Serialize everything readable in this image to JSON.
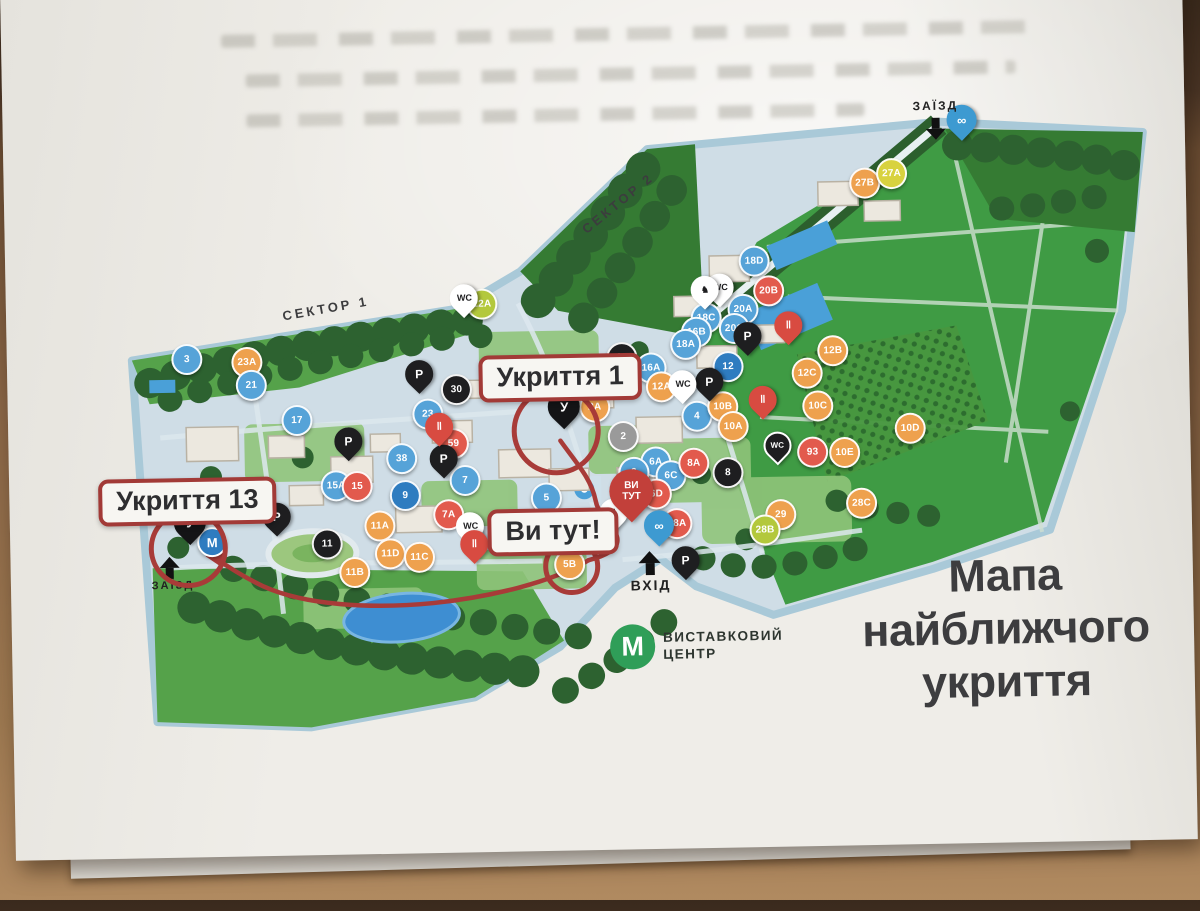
{
  "photo": {
    "title_lines": [
      "Мапа",
      "найближчого",
      "укриття"
    ]
  },
  "map": {
    "sector1": "СЕКТОР 1",
    "sector2": "СЕКТОР 2",
    "entry_top": "ЗАЇЗД",
    "entry_left": "ЗАЇЗД",
    "entrance_bottom": "ВХІД",
    "labels": {
      "shelter1": "Укриття 1",
      "shelter13": "Укриття 13",
      "you_here": "Ви тут!"
    },
    "you_pin": {
      "line1": "ВИ",
      "line2": "ТУТ",
      "x": 630,
      "y": 505
    },
    "metro_station": {
      "glyph": "М",
      "x": 210,
      "y": 535
    },
    "logo": {
      "letter": "М",
      "line1": "ВИСТАВКОВИЙ",
      "line2": "ЦЕНТР"
    },
    "colors": {
      "marker_blue": "#56a3d8",
      "marker_blue_dark": "#2e7cc0",
      "marker_orange": "#eea14e",
      "marker_red": "#e25a4d",
      "marker_black": "#1e1e20",
      "marker_gray": "#9a9a9a",
      "marker_yellow": "#d8d23f",
      "marker_lime": "#b3c83c",
      "route_red": "#a83b38",
      "logo_green": "#2f9e58",
      "title_gray": "#3d3d3f"
    },
    "markers": [
      {
        "label": "27B",
        "x": 869,
        "y": 188,
        "c": "orange"
      },
      {
        "label": "27A",
        "x": 896,
        "y": 179,
        "c": "yellow"
      },
      {
        "label": "22A",
        "x": 484,
        "y": 302,
        "c": "lime"
      },
      {
        "label": "18D",
        "x": 757,
        "y": 264,
        "c": "blue"
      },
      {
        "label": "20B",
        "x": 771,
        "y": 294,
        "c": "red"
      },
      {
        "label": "20A",
        "x": 745,
        "y": 312,
        "c": "blue"
      },
      {
        "label": "18C",
        "x": 708,
        "y": 320,
        "c": "blue"
      },
      {
        "label": "16B",
        "x": 698,
        "y": 334,
        "c": "blue"
      },
      {
        "label": "18A",
        "x": 687,
        "y": 346,
        "c": "blue"
      },
      {
        "label": "20C",
        "x": 736,
        "y": 331,
        "c": "blue"
      },
      {
        "label": "12",
        "x": 729,
        "y": 369,
        "c": "blue2"
      },
      {
        "label": "12B",
        "x": 834,
        "y": 355,
        "c": "orange"
      },
      {
        "label": "12C",
        "x": 808,
        "y": 377,
        "c": "orange"
      },
      {
        "label": "10C",
        "x": 818,
        "y": 410,
        "c": "orange"
      },
      {
        "label": "10E",
        "x": 844,
        "y": 457,
        "c": "orange"
      },
      {
        "label": "10D",
        "x": 910,
        "y": 434,
        "c": "orange"
      },
      {
        "label": "93",
        "x": 812,
        "y": 456,
        "c": "red"
      },
      {
        "label": "28C",
        "x": 860,
        "y": 508,
        "c": "orange"
      },
      {
        "label": "29",
        "x": 779,
        "y": 518,
        "c": "orange"
      },
      {
        "label": "28B",
        "x": 763,
        "y": 533,
        "c": "lime"
      },
      {
        "label": "28A",
        "x": 675,
        "y": 525,
        "c": "red"
      },
      {
        "label": "16",
        "x": 623,
        "y": 358,
        "c": "black"
      },
      {
        "label": "16A",
        "x": 652,
        "y": 369,
        "c": "blue"
      },
      {
        "label": "12A",
        "x": 662,
        "y": 388,
        "c": "orange"
      },
      {
        "label": "2A",
        "x": 595,
        "y": 407,
        "c": "orange"
      },
      {
        "label": "2",
        "x": 623,
        "y": 437,
        "c": "gray"
      },
      {
        "label": "4",
        "x": 697,
        "y": 418,
        "c": "blue"
      },
      {
        "label": "10B",
        "x": 723,
        "y": 409,
        "c": "orange"
      },
      {
        "label": "10A",
        "x": 733,
        "y": 429,
        "c": "orange"
      },
      {
        "label": "6A",
        "x": 655,
        "y": 463,
        "c": "blue"
      },
      {
        "label": "6",
        "x": 633,
        "y": 473,
        "c": "blue"
      },
      {
        "label": "6C",
        "x": 670,
        "y": 477,
        "c": "blue"
      },
      {
        "label": "6D",
        "x": 655,
        "y": 495,
        "c": "red"
      },
      {
        "label": "8A",
        "x": 693,
        "y": 465,
        "c": "red"
      },
      {
        "label": "8",
        "x": 727,
        "y": 475,
        "c": "black"
      },
      {
        "label": "30",
        "x": 457,
        "y": 387,
        "c": "black"
      },
      {
        "label": "23",
        "x": 428,
        "y": 411,
        "c": "blue"
      },
      {
        "label": "59",
        "x": 453,
        "y": 441,
        "c": "red"
      },
      {
        "label": "38",
        "x": 401,
        "y": 455,
        "c": "blue"
      },
      {
        "label": "15A",
        "x": 335,
        "y": 481,
        "c": "blue"
      },
      {
        "label": "15",
        "x": 356,
        "y": 482,
        "c": "red"
      },
      {
        "label": "9",
        "x": 404,
        "y": 492,
        "c": "blue2"
      },
      {
        "label": "7",
        "x": 464,
        "y": 478,
        "c": "blue"
      },
      {
        "label": "7A",
        "x": 447,
        "y": 512,
        "c": "red"
      },
      {
        "label": "11A",
        "x": 378,
        "y": 522,
        "c": "orange"
      },
      {
        "label": "11",
        "x": 325,
        "y": 539,
        "c": "black"
      },
      {
        "label": "11D",
        "x": 388,
        "y": 550,
        "c": "orange"
      },
      {
        "label": "11C",
        "x": 417,
        "y": 554,
        "c": "orange"
      },
      {
        "label": "11B",
        "x": 352,
        "y": 568,
        "c": "orange"
      },
      {
        "label": "5",
        "x": 545,
        "y": 497,
        "c": "blue"
      },
      {
        "label": "5B",
        "x": 567,
        "y": 564,
        "c": "orange"
      },
      {
        "label": "17",
        "x": 297,
        "y": 415,
        "c": "blue"
      },
      {
        "label": "23A",
        "x": 248,
        "y": 356,
        "c": "orange"
      },
      {
        "label": "21",
        "x": 252,
        "y": 379,
        "c": "blue"
      },
      {
        "label": "3",
        "x": 188,
        "y": 352,
        "c": "blue"
      }
    ],
    "pins": [
      {
        "glyph": "P",
        "x": 420,
        "y": 377,
        "s": "black",
        "name": "parking-pin"
      },
      {
        "glyph": "P",
        "x": 348,
        "y": 443,
        "s": "black",
        "name": "parking-pin"
      },
      {
        "glyph": "P",
        "x": 443,
        "y": 462,
        "s": "black",
        "name": "parking-pin"
      },
      {
        "glyph": "P",
        "x": 710,
        "y": 390,
        "s": "black",
        "name": "parking-pin"
      },
      {
        "glyph": "P",
        "x": 749,
        "y": 345,
        "s": "black",
        "name": "parking-pin"
      },
      {
        "glyph": "P",
        "x": 275,
        "y": 517,
        "s": "black",
        "name": "parking-pin"
      },
      {
        "glyph": "P",
        "x": 683,
        "y": 568,
        "s": "black",
        "name": "parking-pin"
      },
      {
        "glyph": "WC",
        "x": 466,
        "y": 302,
        "s": "white",
        "name": "wc-pin"
      },
      {
        "glyph": "WC",
        "x": 722,
        "y": 296,
        "s": "white",
        "name": "wc-pin"
      },
      {
        "glyph": "WC",
        "x": 683,
        "y": 392,
        "s": "white",
        "name": "wc-accessible-pin"
      },
      {
        "glyph": "WC",
        "x": 468,
        "y": 530,
        "s": "white",
        "name": "wc-accessible-pin"
      },
      {
        "glyph": "WC",
        "x": 777,
        "y": 455,
        "s": "blackwc",
        "name": "wc-accessible-pin"
      },
      {
        "glyph": "♞",
        "x": 707,
        "y": 298,
        "s": "white",
        "name": "attraction-pin"
      },
      {
        "glyph": "♟",
        "x": 612,
        "y": 519,
        "s": "white",
        "name": "attraction-pin"
      },
      {
        "glyph": "‖",
        "x": 790,
        "y": 335,
        "s": "red",
        "name": "food-point-pin"
      },
      {
        "glyph": "‖",
        "x": 763,
        "y": 409,
        "s": "red",
        "name": "food-point-pin"
      },
      {
        "glyph": "‖",
        "x": 439,
        "y": 430,
        "s": "red",
        "name": "food-point-pin"
      },
      {
        "glyph": "‖",
        "x": 472,
        "y": 548,
        "s": "red",
        "name": "food-point-pin"
      },
      {
        "glyph": "У",
        "x": 564,
        "y": 413,
        "s": "shelter",
        "name": "shelter-pin-1"
      },
      {
        "glyph": "У",
        "x": 188,
        "y": 522,
        "s": "shelter",
        "name": "shelter-pin-13"
      },
      {
        "glyph": "∞",
        "x": 967,
        "y": 133,
        "s": "bike",
        "name": "bike-rental-pin"
      },
      {
        "glyph": "∞",
        "x": 657,
        "y": 533,
        "s": "bike",
        "name": "bike-rental-pin"
      }
    ]
  }
}
